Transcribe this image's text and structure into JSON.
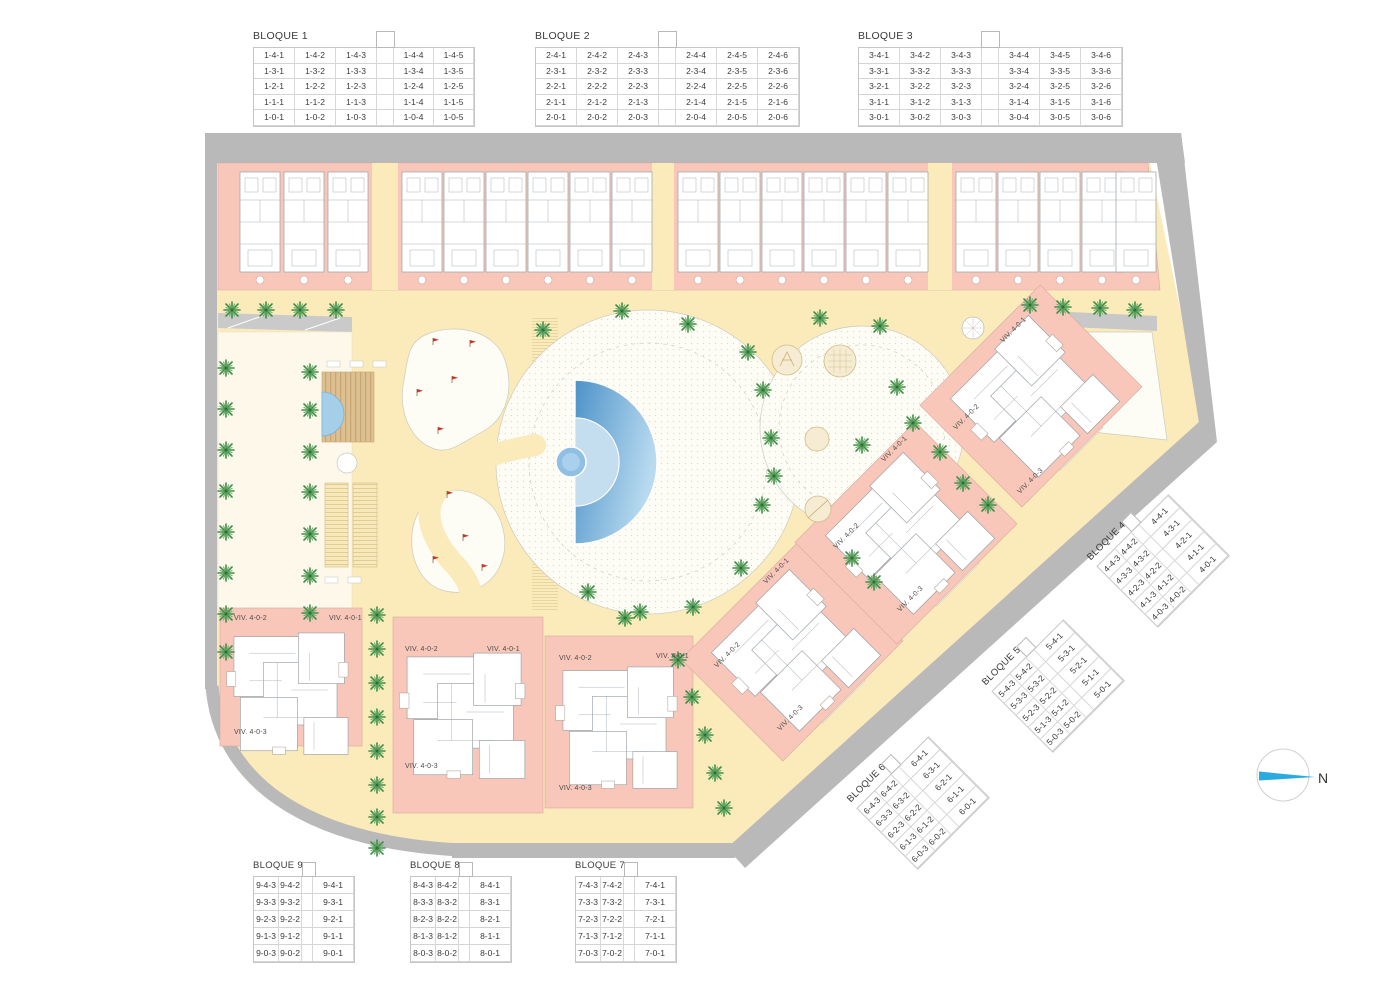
{
  "compass": {
    "north_label": "N"
  },
  "viv_labels": {
    "v1": "VIV. 4-0-1",
    "v2": "VIV. 4-0-2",
    "v3": "VIV. 4-0-3"
  },
  "colors": {
    "road_gray": "#b9b9b9",
    "building_pink": "#f8c7ba",
    "path_yellow": "#fbeaba",
    "lawn_cream": "#fdf8ea",
    "plaza_white": "#fdfcf5",
    "pool_blue": "#4f93c8",
    "palm_green": "#3f8f4c",
    "flag_red": "#c0392b",
    "north_cyan": "#29abe2",
    "play_tan": "#f6ecd3"
  },
  "tables": {
    "b1": {
      "label": "BLOQUE 1",
      "rows": [
        [
          "1-4-1",
          "1-4-2",
          "1-4-3",
          "",
          "1-4-4",
          "1-4-5"
        ],
        [
          "1-3-1",
          "1-3-2",
          "1-3-3",
          "",
          "1-3-4",
          "1-3-5"
        ],
        [
          "1-2-1",
          "1-2-2",
          "1-2-3",
          "",
          "1-2-4",
          "1-2-5"
        ],
        [
          "1-1-1",
          "1-1-2",
          "1-1-3",
          "",
          "1-1-4",
          "1-1-5"
        ],
        [
          "1-0-1",
          "1-0-2",
          "1-0-3",
          "",
          "1-0-4",
          "1-0-5"
        ]
      ]
    },
    "b2": {
      "label": "BLOQUE 2",
      "rows": [
        [
          "2-4-1",
          "2-4-2",
          "2-4-3",
          "",
          "2-4-4",
          "2-4-5",
          "2-4-6"
        ],
        [
          "2-3-1",
          "2-3-2",
          "2-3-3",
          "",
          "2-3-4",
          "2-3-5",
          "2-3-6"
        ],
        [
          "2-2-1",
          "2-2-2",
          "2-2-3",
          "",
          "2-2-4",
          "2-2-5",
          "2-2-6"
        ],
        [
          "2-1-1",
          "2-1-2",
          "2-1-3",
          "",
          "2-1-4",
          "2-1-5",
          "2-1-6"
        ],
        [
          "2-0-1",
          "2-0-2",
          "2-0-3",
          "",
          "2-0-4",
          "2-0-5",
          "2-0-6"
        ]
      ]
    },
    "b3": {
      "label": "BLOQUE 3",
      "rows": [
        [
          "3-4-1",
          "3-4-2",
          "3-4-3",
          "",
          "3-4-4",
          "3-4-5",
          "3-4-6"
        ],
        [
          "3-3-1",
          "3-3-2",
          "3-3-3",
          "",
          "3-3-4",
          "3-3-5",
          "3-3-6"
        ],
        [
          "3-2-1",
          "3-2-2",
          "3-2-3",
          "",
          "3-2-4",
          "3-2-5",
          "3-2-6"
        ],
        [
          "3-1-1",
          "3-1-2",
          "3-1-3",
          "",
          "3-1-4",
          "3-1-5",
          "3-1-6"
        ],
        [
          "3-0-1",
          "3-0-2",
          "3-0-3",
          "",
          "3-0-4",
          "3-0-5",
          "3-0-6"
        ]
      ]
    },
    "b4": {
      "label": "BLOQUE 4",
      "rows": [
        [
          "4-4-3",
          "4-4-2",
          "",
          "4-4-1"
        ],
        [
          "4-3-3",
          "4-3-2",
          "",
          "4-3-1"
        ],
        [
          "4-2-3",
          "4-2-2",
          "",
          "4-2-1"
        ],
        [
          "4-1-3",
          "4-1-2",
          "",
          "4-1-1"
        ],
        [
          "4-0-3",
          "4-0-2",
          "",
          "4-0-1"
        ]
      ]
    },
    "b5": {
      "label": "BLOQUE 5",
      "rows": [
        [
          "5-4-3",
          "5-4-2",
          "",
          "5-4-1"
        ],
        [
          "5-3-3",
          "5-3-2",
          "",
          "5-3-1"
        ],
        [
          "5-2-3",
          "5-2-2",
          "",
          "5-2-1"
        ],
        [
          "5-1-3",
          "5-1-2",
          "",
          "5-1-1"
        ],
        [
          "5-0-3",
          "5-0-2",
          "",
          "5-0-1"
        ]
      ]
    },
    "b6": {
      "label": "BLOQUE 6",
      "rows": [
        [
          "6-4-3",
          "6-4-2",
          "",
          "6-4-1"
        ],
        [
          "6-3-3",
          "6-3-2",
          "",
          "6-3-1"
        ],
        [
          "6-2-3",
          "6-2-2",
          "",
          "6-2-1"
        ],
        [
          "6-1-3",
          "6-1-2",
          "",
          "6-1-1"
        ],
        [
          "6-0-3",
          "6-0-2",
          "",
          "6-0-1"
        ]
      ]
    },
    "b7": {
      "label": "BLOQUE 7",
      "rows": [
        [
          "7-4-3",
          "7-4-2",
          "",
          "7-4-1"
        ],
        [
          "7-3-3",
          "7-3-2",
          "",
          "7-3-1"
        ],
        [
          "7-2-3",
          "7-2-2",
          "",
          "7-2-1"
        ],
        [
          "7-1-3",
          "7-1-2",
          "",
          "7-1-1"
        ],
        [
          "7-0-3",
          "7-0-2",
          "",
          "7-0-1"
        ]
      ]
    },
    "b8": {
      "label": "BLOQUE 8",
      "rows": [
        [
          "8-4-3",
          "8-4-2",
          "",
          "8-4-1"
        ],
        [
          "8-3-3",
          "8-3-2",
          "",
          "8-3-1"
        ],
        [
          "8-2-3",
          "8-2-2",
          "",
          "8-2-1"
        ],
        [
          "8-1-3",
          "8-1-2",
          "",
          "8-1-1"
        ],
        [
          "8-0-3",
          "8-0-2",
          "",
          "8-0-1"
        ]
      ]
    },
    "b9": {
      "label": "BLOQUE 9",
      "rows": [
        [
          "9-4-3",
          "9-4-2",
          "",
          "9-4-1"
        ],
        [
          "9-3-3",
          "9-3-2",
          "",
          "9-3-1"
        ],
        [
          "9-2-3",
          "9-2-2",
          "",
          "9-2-1"
        ],
        [
          "9-1-3",
          "9-1-2",
          "",
          "9-1-1"
        ],
        [
          "9-0-3",
          "9-0-2",
          "",
          "9-0-1"
        ]
      ]
    }
  }
}
